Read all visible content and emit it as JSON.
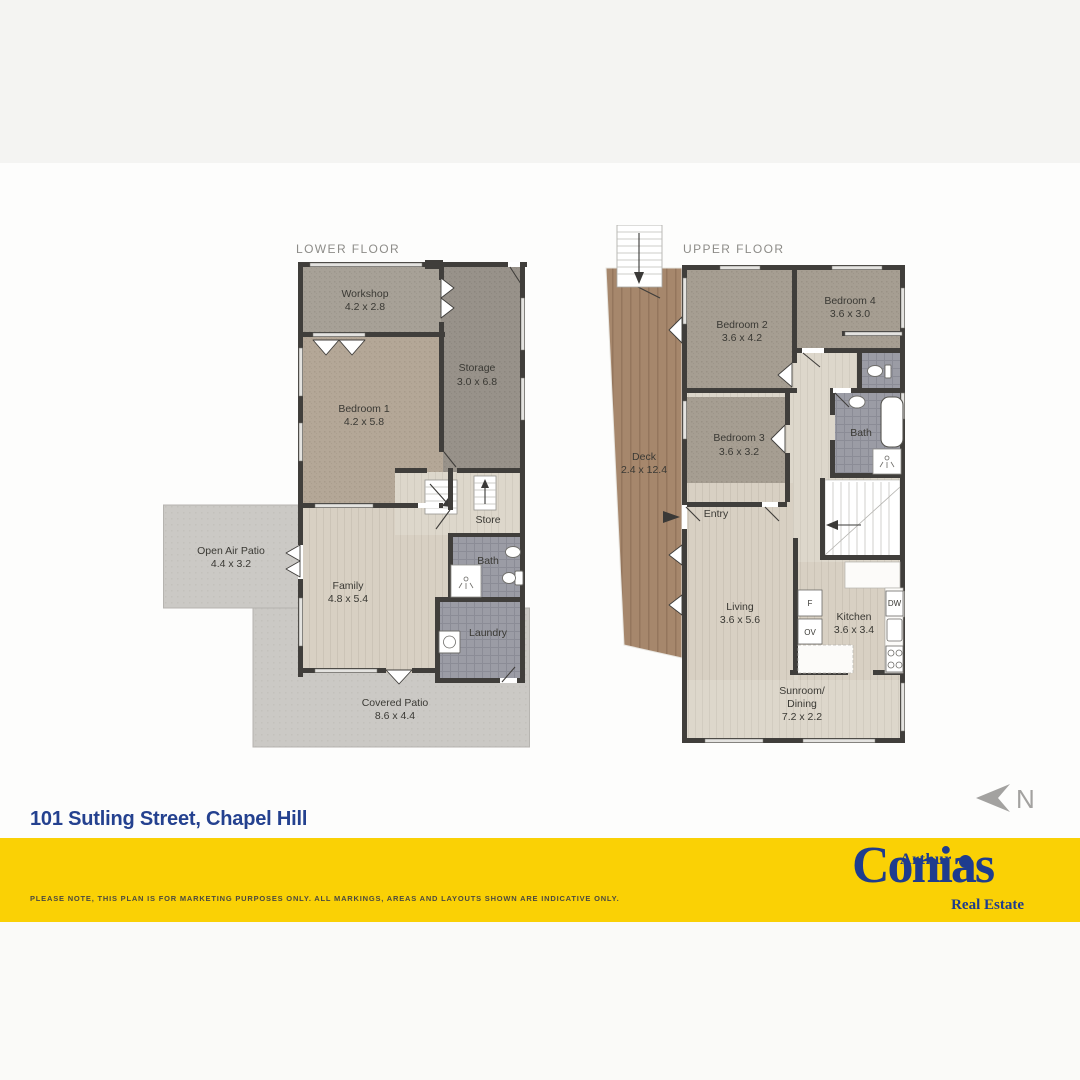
{
  "page": {
    "address": "101 Sutling Street, Chapel Hill",
    "disclaimer": "PLEASE NOTE, THIS PLAN IS FOR MARKETING PURPOSES ONLY. ALL MARKINGS, AREAS AND LAYOUTS SHOWN ARE INDICATIVE ONLY.",
    "north_label": "N"
  },
  "branding": {
    "line1": "Arthur",
    "line2": "Conias",
    "line3": "Real Estate",
    "brand_blue": "#1e3c8e",
    "banner_yellow": "#fad105"
  },
  "lower": {
    "title": "LOWER FLOOR",
    "rooms": {
      "workshop": {
        "name": "Workshop",
        "dims": "4.2 x 2.8"
      },
      "storage": {
        "name": "Storage",
        "dims": "3.0 x 6.8"
      },
      "bedroom1": {
        "name": "Bedroom 1",
        "dims": "4.2 x 5.8"
      },
      "open_patio": {
        "name": "Open Air Patio",
        "dims": "4.4 x 3.2"
      },
      "family": {
        "name": "Family",
        "dims": "4.8 x 5.4"
      },
      "store": {
        "name": "Store"
      },
      "bath": {
        "name": "Bath"
      },
      "laundry": {
        "name": "Laundry"
      },
      "cov_patio": {
        "name": "Covered Patio",
        "dims": "8.6 x 4.4"
      }
    }
  },
  "upper": {
    "title": "UPPER FLOOR",
    "rooms": {
      "deck": {
        "name": "Deck",
        "dims": "2.4 x 12.4"
      },
      "bedroom2": {
        "name": "Bedroom 2",
        "dims": "3.6 x 4.2"
      },
      "bedroom4": {
        "name": "Bedroom 4",
        "dims": "3.6 x 3.0"
      },
      "bedroom3": {
        "name": "Bedroom 3",
        "dims": "3.6 x 3.2"
      },
      "bath": {
        "name": "Bath"
      },
      "entry": {
        "name": "Entry"
      },
      "living": {
        "name": "Living",
        "dims": "3.6 x 5.6"
      },
      "kitchen": {
        "name": "Kitchen",
        "dims": "3.6 x 3.4"
      },
      "sunroom": {
        "name": "Sunroom/",
        "name2": "Dining",
        "dims": "7.2 x 2.2"
      },
      "fridge": "F",
      "oven": "OV",
      "dishwasher": "DW"
    }
  }
}
